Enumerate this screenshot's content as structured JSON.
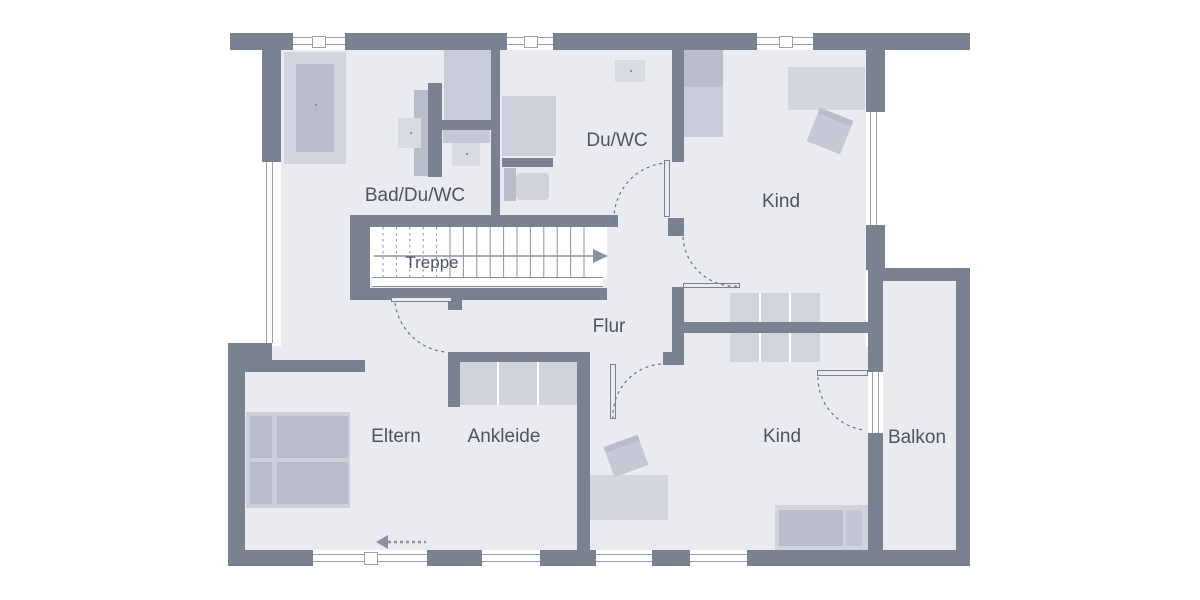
{
  "floorplan": {
    "type": "floor-plan-upper-storey",
    "labels": {
      "bad": "Bad/Du/WC",
      "treppe": "Treppe",
      "duwc": "Du/WC",
      "kind_top": "Kind",
      "flur": "Flur",
      "eltern": "Eltern",
      "ankleide": "Ankleide",
      "kind_bottom": "Kind",
      "balkon": "Balkon"
    },
    "icons": [
      "stair-direction-arrow",
      "entrance-direction-arrow",
      "door-swing-arc"
    ],
    "colors": {
      "wall": "#7a8191",
      "floor": "#e9ebf1",
      "furniture_light": "#d2d5de",
      "furniture_medium": "#c5c9d4",
      "furniture_dark": "#b8bdc9",
      "line": "#8b92a2",
      "text": "#4d5565",
      "background": "#ffffff"
    }
  }
}
